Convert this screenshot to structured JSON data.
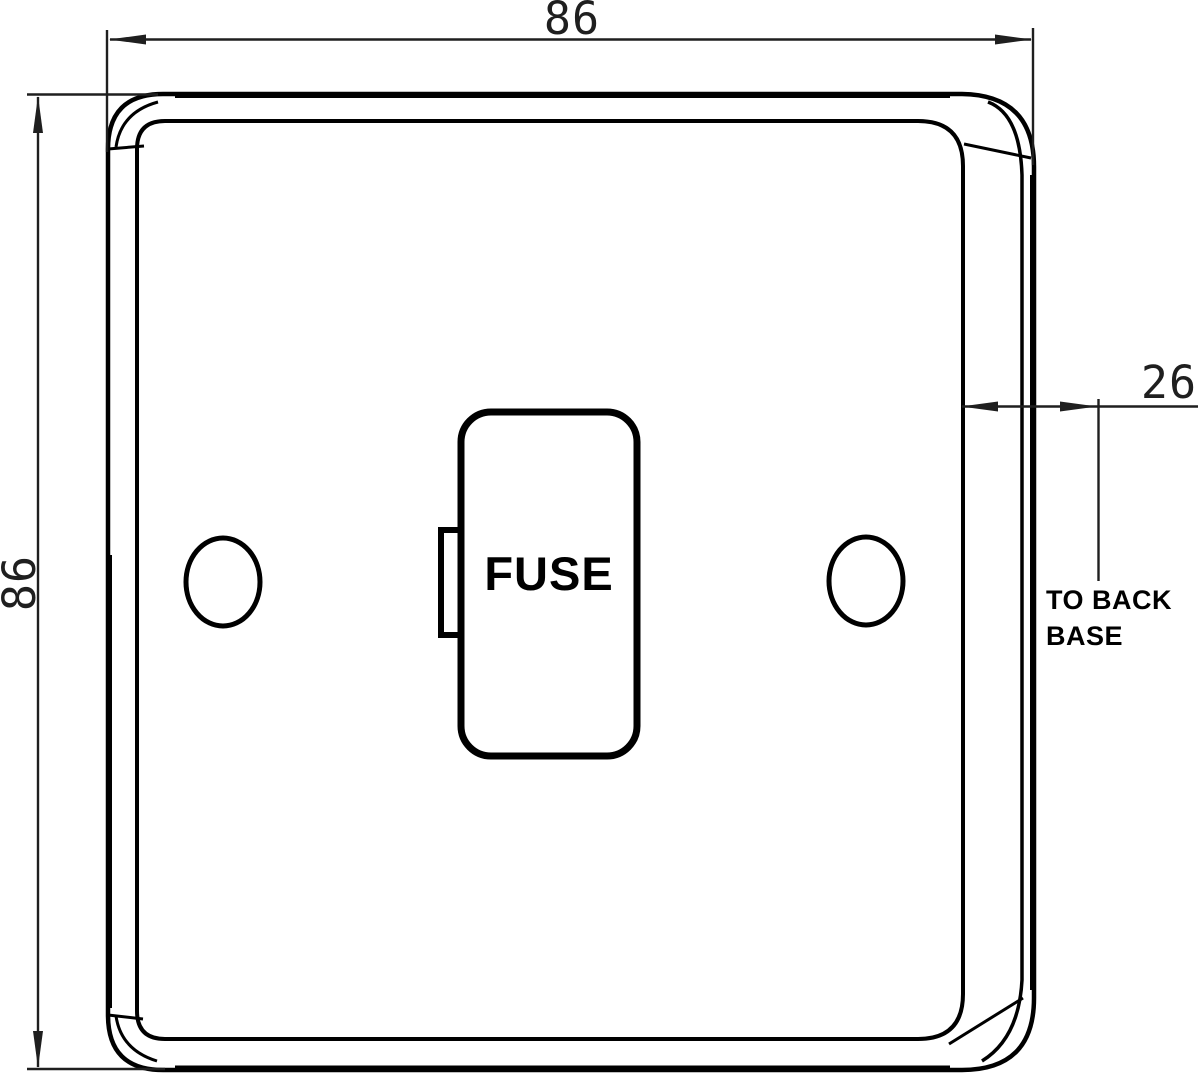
{
  "colors": {
    "background": "#ffffff",
    "line": "#000000",
    "dim_line": "#1f1f1f"
  },
  "dimensions": {
    "width": {
      "value": "86"
    },
    "height": {
      "value": "86"
    },
    "depth": {
      "value": "26",
      "note_line1": "TO BACK",
      "note_line2": "BASE"
    }
  },
  "faceplate": {
    "fuse_label": "FUSE"
  }
}
